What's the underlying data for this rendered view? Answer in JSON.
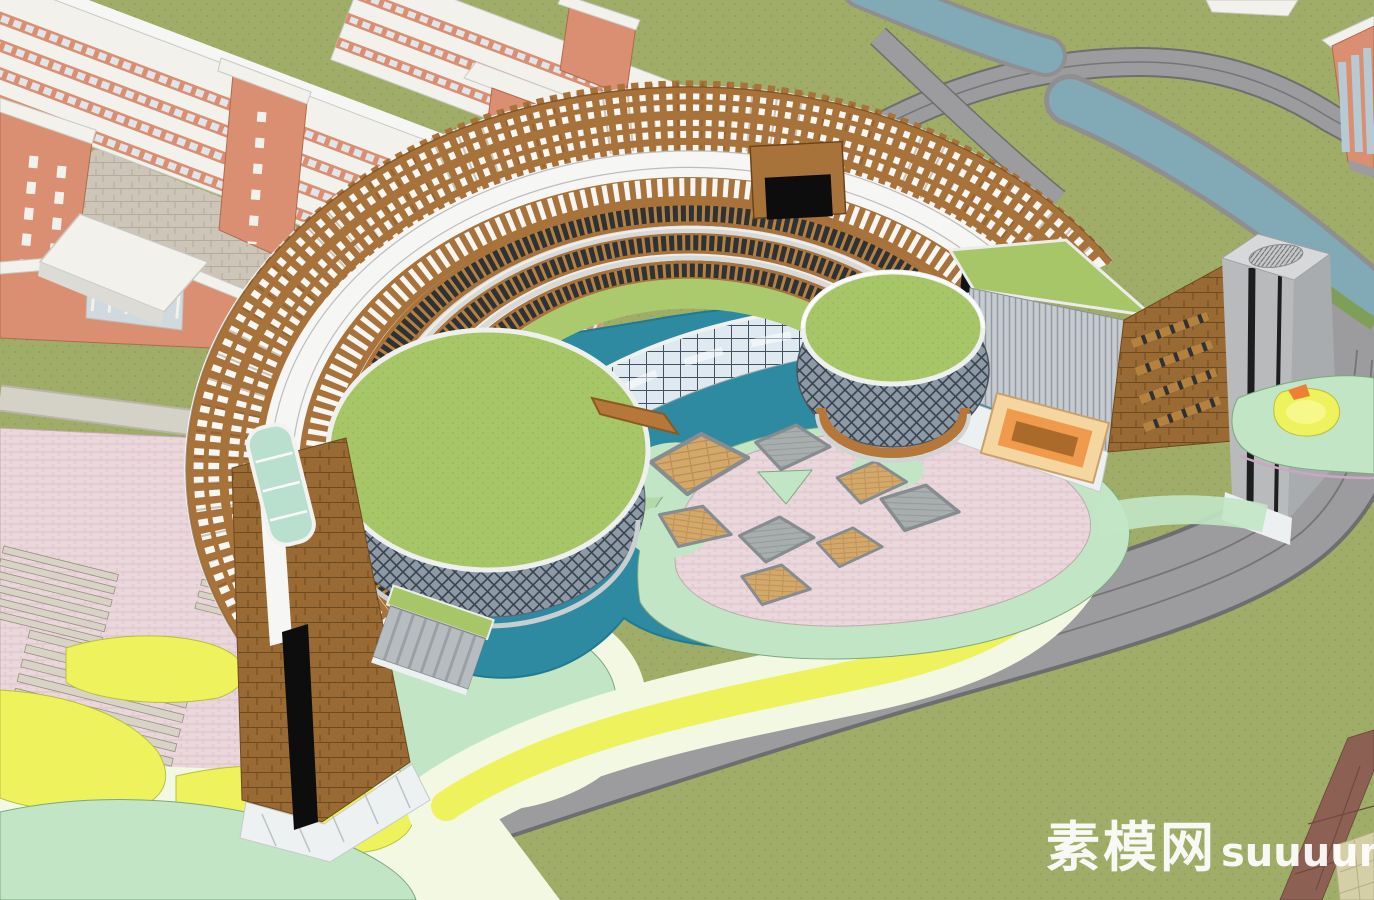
{
  "watermark": {
    "site_cn": "素模网",
    "site_en": "suuuum.com"
  },
  "palette": {
    "grass": "#a0ad68",
    "grassDot": "#93a25a",
    "road": "#9c9c9e",
    "roadEdge": "#6e6e70",
    "roadLine": "#747578",
    "walk": "#d4d1c6",
    "walkEdge": "#b9b5a8",
    "river": "#81aab6",
    "riverBank": "#8f8f90",
    "hedge": "#7f9e58",
    "pond": "#2d8aa0",
    "pondEdge": "#1f7a92",
    "pondShallow": "#cfe6ad",
    "cream": "#f3f8e2",
    "mint": "#c2e5c5",
    "mintEdge": "#7da87f",
    "yellow": "#eef25c",
    "yellowEdge": "#b8bf3f",
    "pink": "#ead7dc",
    "pinkLine": "#dcc2c9",
    "pinkEdge": "#c0a9af",
    "pergola": "#a8723b",
    "pergolaDark": "#6b4519",
    "white": "#f6f6f4",
    "grayLine": "#bdbdbd",
    "tierWood": "#b5813f",
    "tierGlass": "#2e3136",
    "sill": "#ededeb",
    "step": "#d8d8d6",
    "terrace": "#abc96d",
    "greenRoof": "#a7c667",
    "greenRoofDot": "#9aba59",
    "glass": "#dfeaf0",
    "mullion": "#425062",
    "glassEdge": "#f0f0ee",
    "lattice": "#8d9aa6",
    "latticeLine": "#39434f",
    "rim": "#eef0ee",
    "deck": "#b5773a",
    "deckDark": "#8a5a22",
    "salmon": "#da8f73",
    "salmonDark": "#b06a4d",
    "dormWhite": "#f2f1ec",
    "dormEdge": "#c9c9c4",
    "dormWindow": "#dfe5e8",
    "dormShadow": "#dcdbd5",
    "paver": "#ccc5b8",
    "paverLine": "#b3ab9c",
    "louver": "#c6cbd0",
    "louverLine": "#939aa1",
    "shingle": "#9a6a35",
    "shingleLine": "#6e4a1f",
    "tower": "#b8babc",
    "towerSide": "#a8acae",
    "towerTop": "#d6d8d9",
    "towerStripe": "#1e1e1e",
    "plinth": "#edf0f0",
    "peach": "#f6d6a0",
    "peachEdge": "#caa06b",
    "orange": "#ef9a4d",
    "orangeDark": "#a96a2a",
    "orangeBright": "#ef7f35",
    "brownPath": "#8c6153",
    "brownPathLine": "#6f4b3f",
    "khaki": "#d5cfa8",
    "khakiLine": "#b5ae84",
    "platGray": "#a8adad",
    "platGrayLine": "#8f9596",
    "frameGray": "#878c90",
    "wood": "#d3a86b",
    "woodLine": "#b98a4e",
    "stair": "#d8d3c6",
    "stairEdge": "#96917f",
    "canopy": "#b9e0cf",
    "slotBlack": "#111417",
    "black": "#0d0d0d",
    "watermark": "#ffffff"
  }
}
